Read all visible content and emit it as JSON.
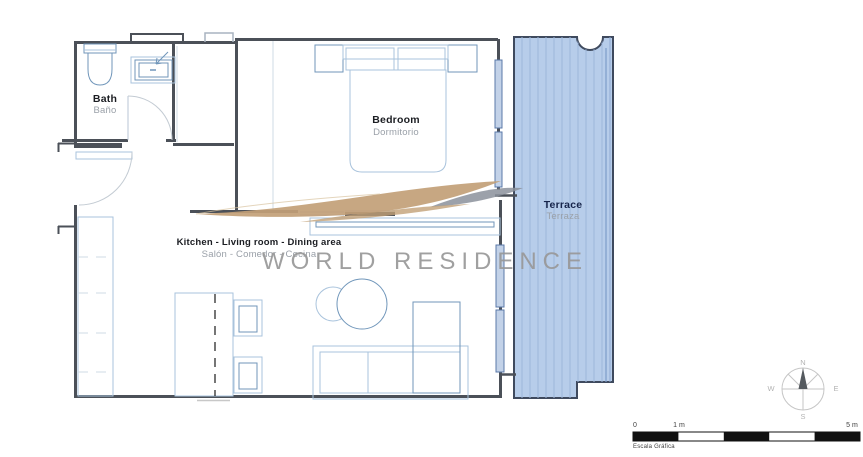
{
  "rooms": {
    "bath": {
      "label": "Bath",
      "sublabel": "Baño"
    },
    "bedroom": {
      "label": "Bedroom",
      "sublabel": "Dormitorio"
    },
    "living": {
      "label": "Kitchen - Living room - Dining area",
      "sublabel": "Salón - Comedor - Cocina"
    },
    "terrace": {
      "label": "Terrace",
      "sublabel": "Terraza"
    }
  },
  "watermark": {
    "text": "WORLD RESIDENCE"
  },
  "compass": {
    "n": "N",
    "s": "S",
    "e": "E",
    "w": "W"
  },
  "scale_bar": {
    "zero": "0",
    "one": "1 m",
    "five": "5 m",
    "caption": "Escala Gráfica"
  },
  "colors": {
    "wall": "#4b5058",
    "furniture_light": "#a9c3dc",
    "furniture_mid": "#7096ba",
    "terrace_fill": "#b7cdea",
    "terrace_stripe": "#9cb6db",
    "terrace_border": "#3f4a5e",
    "label_dark": "#1b1d22",
    "label_terrace": "#16244a",
    "label_gray": "#9aa0a8",
    "watermark_gray": "#989898",
    "swoosh_tan": "#c2a077"
  }
}
